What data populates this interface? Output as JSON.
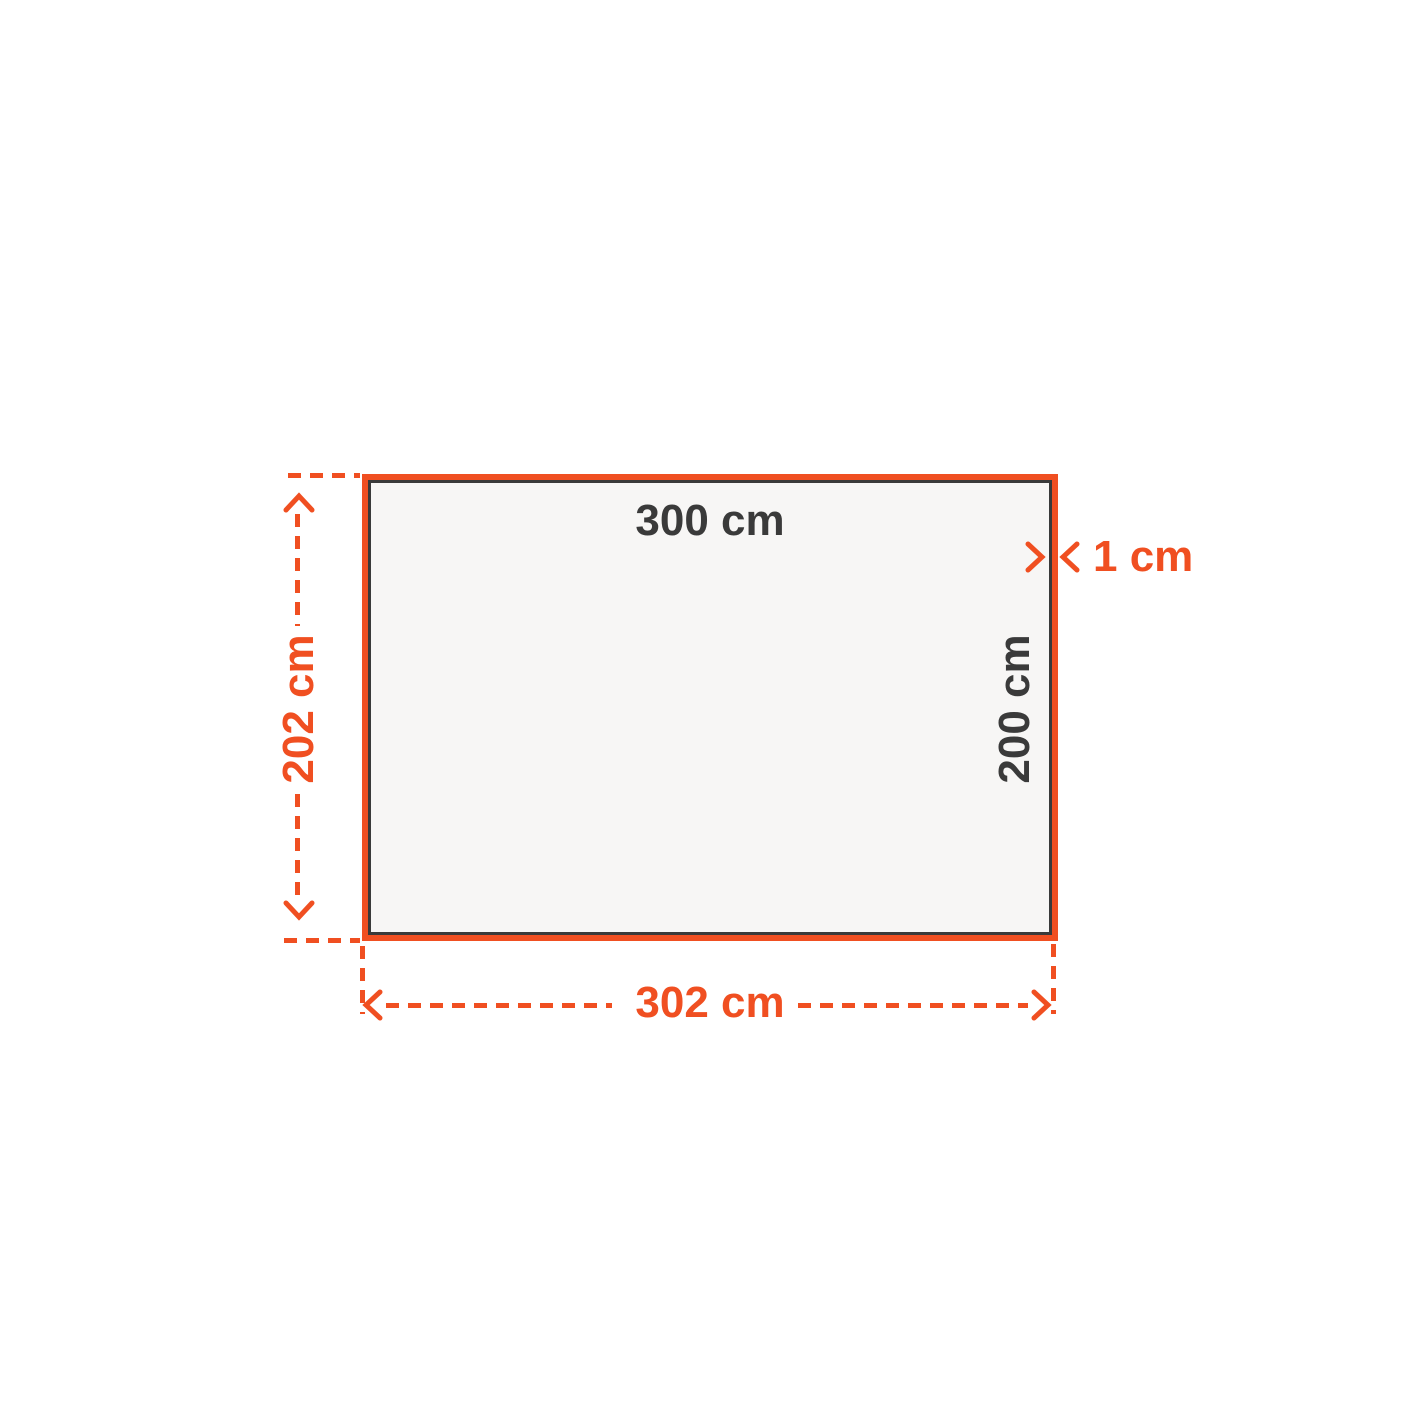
{
  "diagram": {
    "type": "dimension-diagram",
    "labels": {
      "inner_width": "300 cm",
      "inner_height": "200 cm",
      "border_thickness": "1 cm",
      "outer_height": "202 cm",
      "outer_width": "302 cm"
    },
    "colors": {
      "accent": "#F04F21",
      "ink": "#3A3A3A",
      "panel-fill": "#F7F6F5",
      "panel-inner-border": "#3A3A3A",
      "background": "#FFFFFF"
    }
  }
}
